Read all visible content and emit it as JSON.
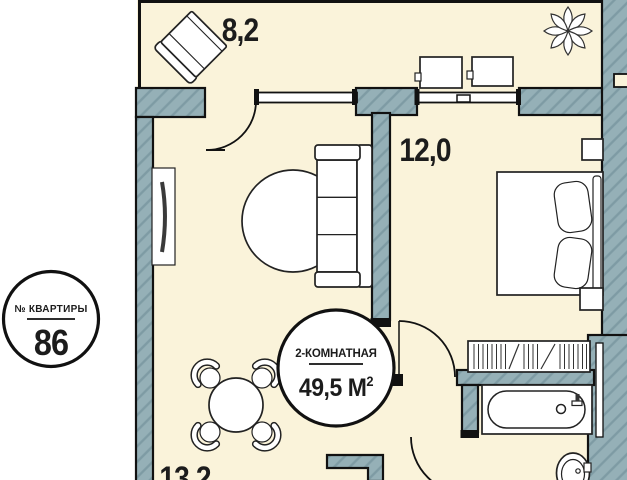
{
  "badges": {
    "apartment": {
      "label": "№ КВАРТИРЫ",
      "number": "86"
    },
    "type": {
      "name": "2-КОМНАТНАЯ",
      "area_text": "49,5 М",
      "area_sup": "2"
    }
  },
  "rooms": {
    "balcony": {
      "area_label": "8,2"
    },
    "bedroom": {
      "area_label": "12,0"
    },
    "living_kitchen": {
      "area_label": "13,2"
    }
  },
  "colors": {
    "background": "#ffffff",
    "floor": "#faf3da",
    "wall_fill": "#95b0b7",
    "wall_hatch": "#7e9ba4",
    "outline": "#111111",
    "furniture_fill": "#ffffff",
    "text": "#1c1c1c"
  }
}
